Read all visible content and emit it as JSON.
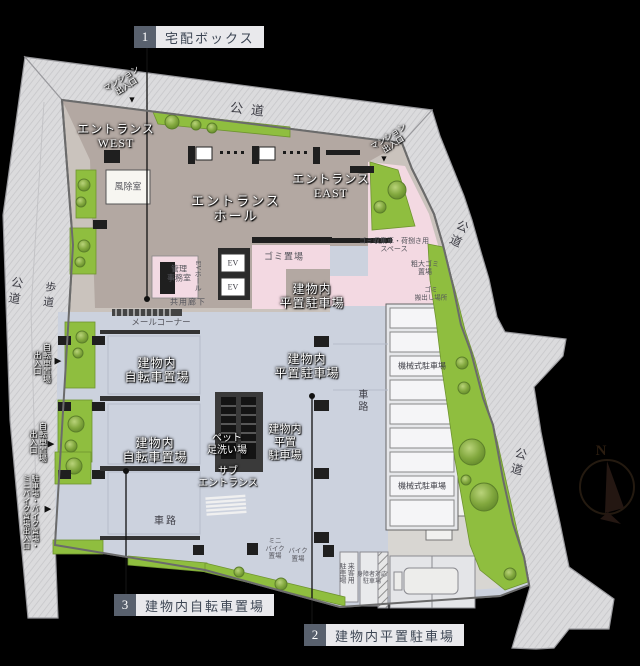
{
  "callouts": {
    "box1": {
      "number": "1",
      "label": "宅配ボックス"
    },
    "box2": {
      "number": "2",
      "label": "建物内平置駐車場"
    },
    "box3": {
      "number": "3",
      "label": "建物内自転車置場"
    }
  },
  "roads": {
    "public_road": "公道",
    "sidewalk": "歩道"
  },
  "entrances": {
    "mansion_entrance": "マンション\n出入口",
    "entrance_west": "エントランス\nWEST",
    "entrance_east": "エントランス\nEAST",
    "entrance_hall": "エントランス\nホール",
    "sub_entrance": "サブ\nエントランス",
    "bicycle_entrance": "自転車置場\n出入口",
    "parking_entrance": "駐車場・バイク置場・\nミニバイク置場出入口"
  },
  "rooms": {
    "windbreak": "風除室",
    "management_office": "管理\n事務室",
    "ev_hall": "EVホール",
    "elevator": "EV",
    "garbage_room": "ゴミ置場",
    "common_corridor": "共用廊下",
    "mail_corner": "メールコーナー",
    "pet_foot_wash": "ペット\n足洗い場"
  },
  "parking": {
    "flat_parking_2line": "建物内\n平置駐車場",
    "flat_parking_3line": "建物内\n平置\n駐車場",
    "bicycle_parking": "建物内\n自転車置場",
    "mechanical_parking": "機械式駐車場",
    "mini_bike": "ミニ\nバイク\n置場",
    "bike": "バイク\n置場",
    "visitor_parking": "来客用\n駐車場",
    "accessible_parking": "身障者対応\n駐車場",
    "driveway": "車路"
  },
  "garbage": {
    "collection_space": "ゴミ収集車・荷捌き用\nスペース",
    "bulky_garbage": "粗大ゴミ\n置場",
    "garbage_out": "ゴミ\n搬出し場所"
  },
  "compass": {
    "north": "N"
  },
  "markers": {
    "arrow_down": "▼",
    "arrow_right": "▶"
  }
}
